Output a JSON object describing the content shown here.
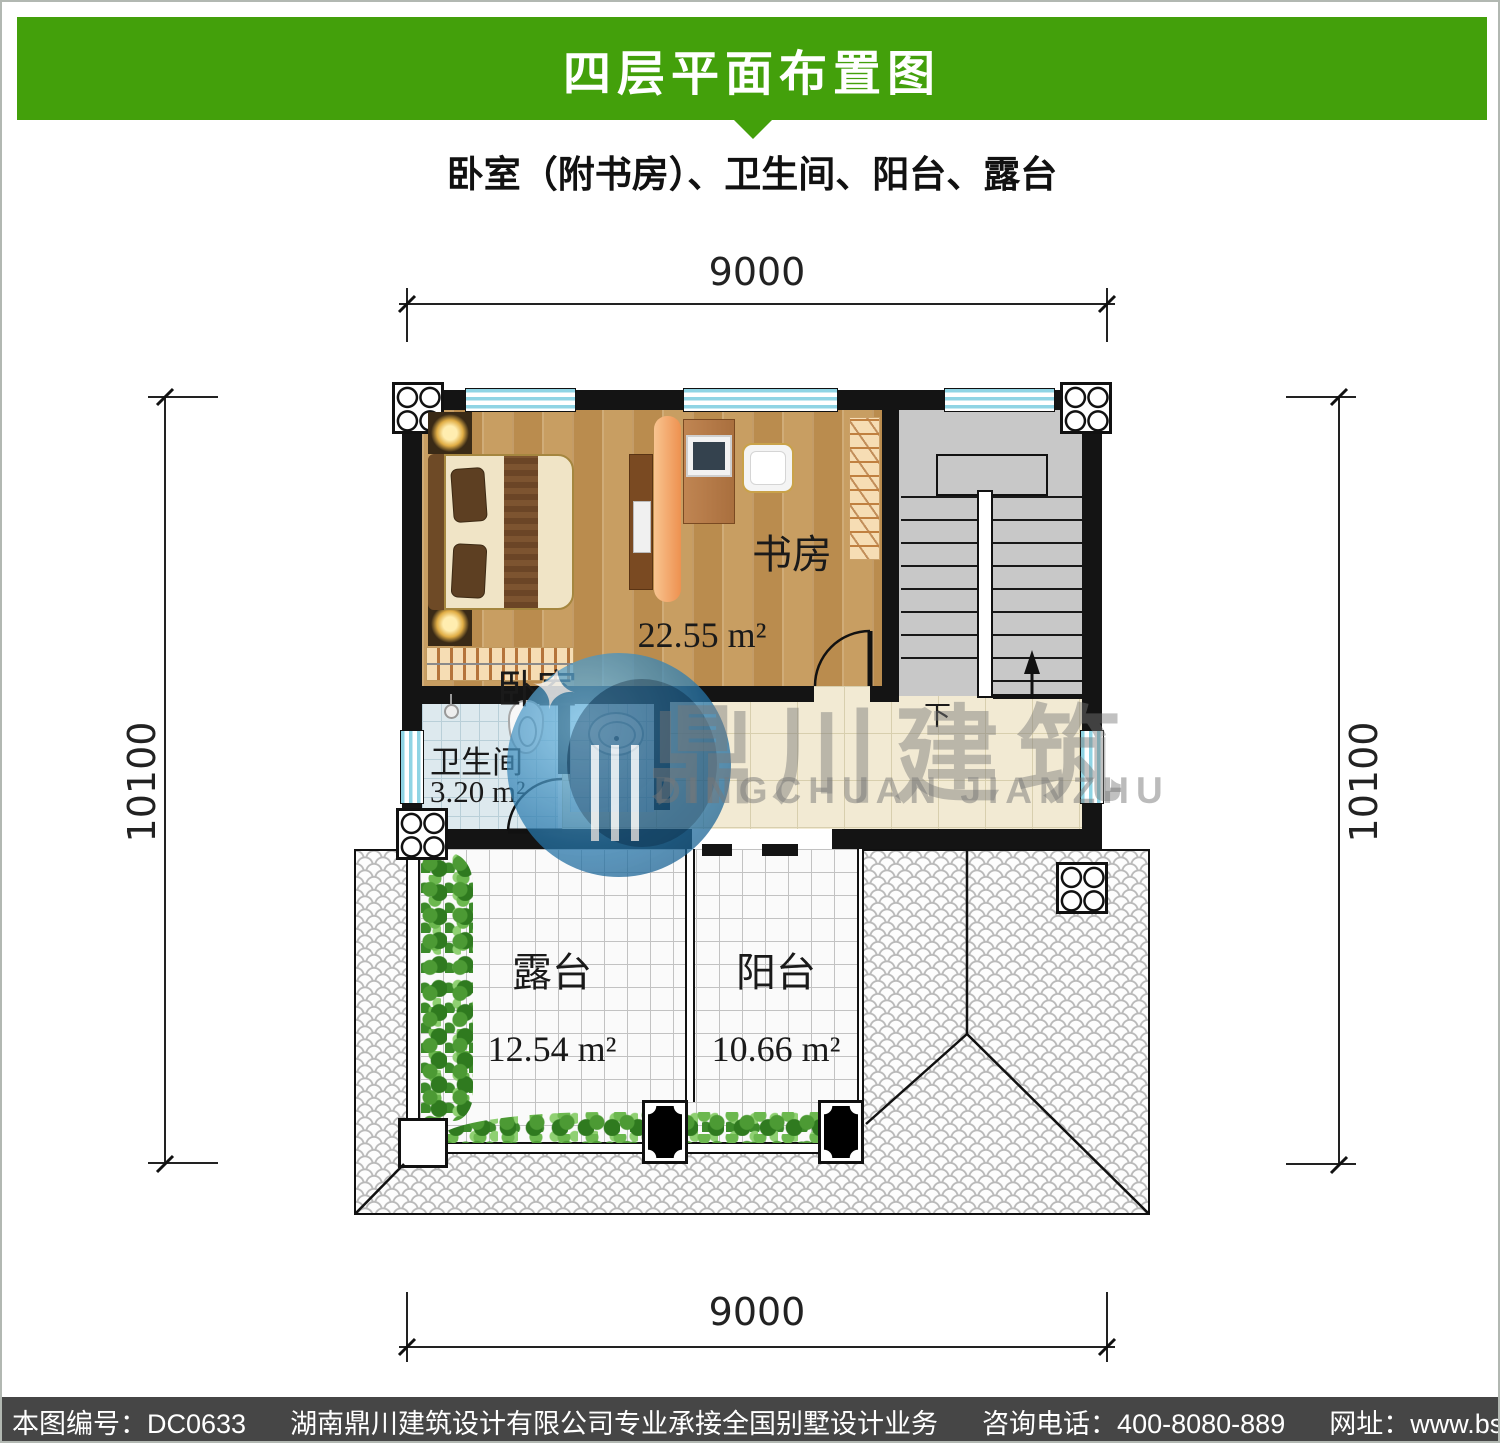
{
  "header": {
    "title": "四层平面布置图",
    "bg_color": "#43a00b",
    "text_color": "#ffffff"
  },
  "subtitle": "卧室（附书房）、卫生间、阳台、露台",
  "dimensions": {
    "top": "9000",
    "bottom": "9000",
    "left": "10100",
    "right": "10100"
  },
  "rooms": {
    "bedroom": "卧室",
    "study": "书房",
    "combined_area": "22.55 m²",
    "bathroom": "卫生间",
    "bathroom_area": "3.20 m²",
    "terrace": "露台",
    "terrace_area": "12.54 m²",
    "balcony": "阳台",
    "balcony_area": "10.66 m²",
    "stair_down": "下"
  },
  "watermark": {
    "cn": "鼎川建筑",
    "en": "DINGCHUAN JIANZHU",
    "star": "✦"
  },
  "footer": {
    "bg_color": "#464646",
    "serial": "本图编号：DC0633",
    "company": "湖南鼎川建筑设计有限公司专业承接全国别墅设计业务",
    "phone": "咨询电话：400-8080-889",
    "website": "网址：www.bstzcs.com"
  },
  "colors": {
    "wall": "#141414",
    "window_blue": "#8fd4e4",
    "wood_floor": "#c59a5f",
    "stair_gray": "#c8c8c8",
    "hall_tile": "#f2ead3",
    "bath_tile": "#dde9ee",
    "accent_orange": "#ee9150",
    "plant_green": "#4c9a34",
    "logo_blue": "#2676aa"
  }
}
